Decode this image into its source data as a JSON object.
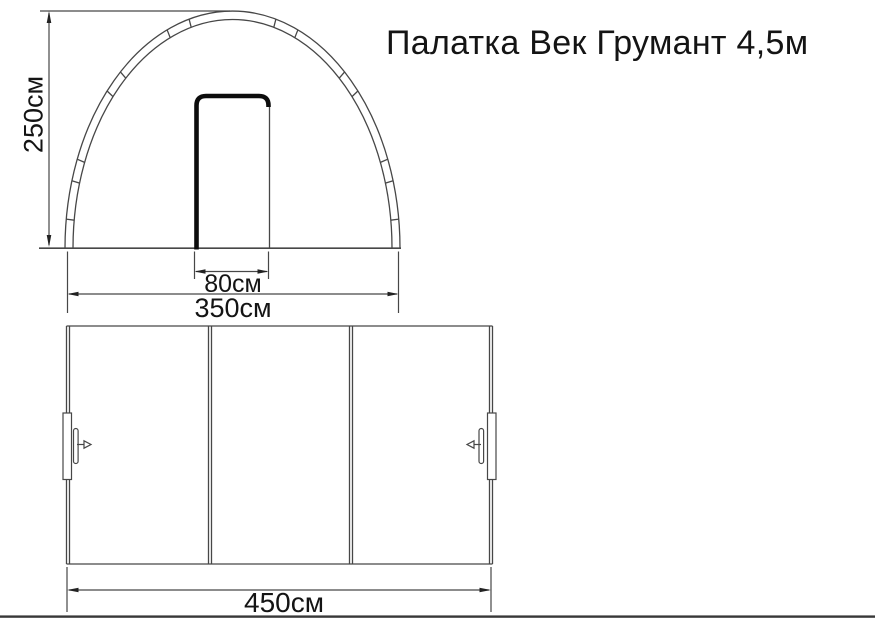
{
  "title": "Палатка Век Грумант 4,5м",
  "front_view": {
    "height_label": "250см",
    "door_width_label": "80см",
    "width_label": "350см"
  },
  "side_view": {
    "length_label": "450см",
    "section_count": 3
  },
  "dimensions_cm": {
    "height": 250,
    "width": 350,
    "door_width": 80,
    "length": 450
  },
  "colors": {
    "background": "#ffffff",
    "line": "#474747",
    "ink": "#141414",
    "door_stroke": "#0c0c0c",
    "bottom_edge": "#383838"
  }
}
